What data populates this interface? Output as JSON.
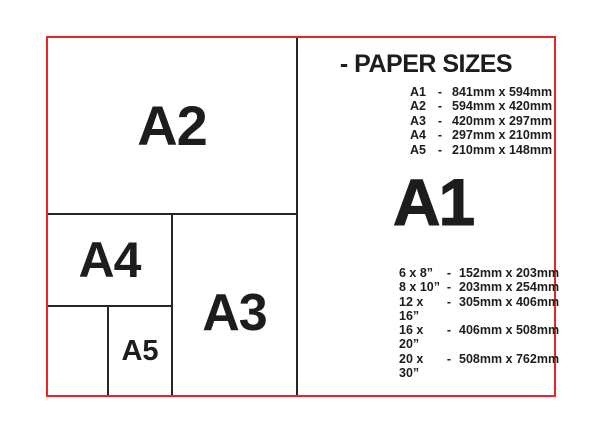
{
  "colors": {
    "frame_red": "#ec2426",
    "line_black": "#262626",
    "text_black": "#1d1d1b",
    "background": "#ffffff"
  },
  "diagram": {
    "a2_label": "A2",
    "a3_label": "A3",
    "a4_label": "A4",
    "a5_label": "A5"
  },
  "panel": {
    "title": "- PAPER SIZES",
    "featured_size": "A1",
    "a_series": [
      {
        "label": "A1",
        "dash": "-",
        "value": "841mm x 594mm"
      },
      {
        "label": "A2",
        "dash": "-",
        "value": "594mm x 420mm"
      },
      {
        "label": "A3",
        "dash": "-",
        "value": "420mm x 297mm"
      },
      {
        "label": "A4",
        "dash": "-",
        "value": "297mm x 210mm"
      },
      {
        "label": "A5",
        "dash": "-",
        "value": "210mm x 148mm"
      }
    ],
    "inch_series": [
      {
        "label": "6 x 8”",
        "dash": "-",
        "value": "152mm x 203mm"
      },
      {
        "label": "8 x 10”",
        "dash": "-",
        "value": "203mm x 254mm"
      },
      {
        "label": "12 x 16”",
        "dash": "-",
        "value": "305mm x 406mm"
      },
      {
        "label": "16 x 20”",
        "dash": "-",
        "value": "406mm x 508mm"
      },
      {
        "label": "20 x 30”",
        "dash": "-",
        "value": "508mm x 762mm"
      }
    ]
  }
}
